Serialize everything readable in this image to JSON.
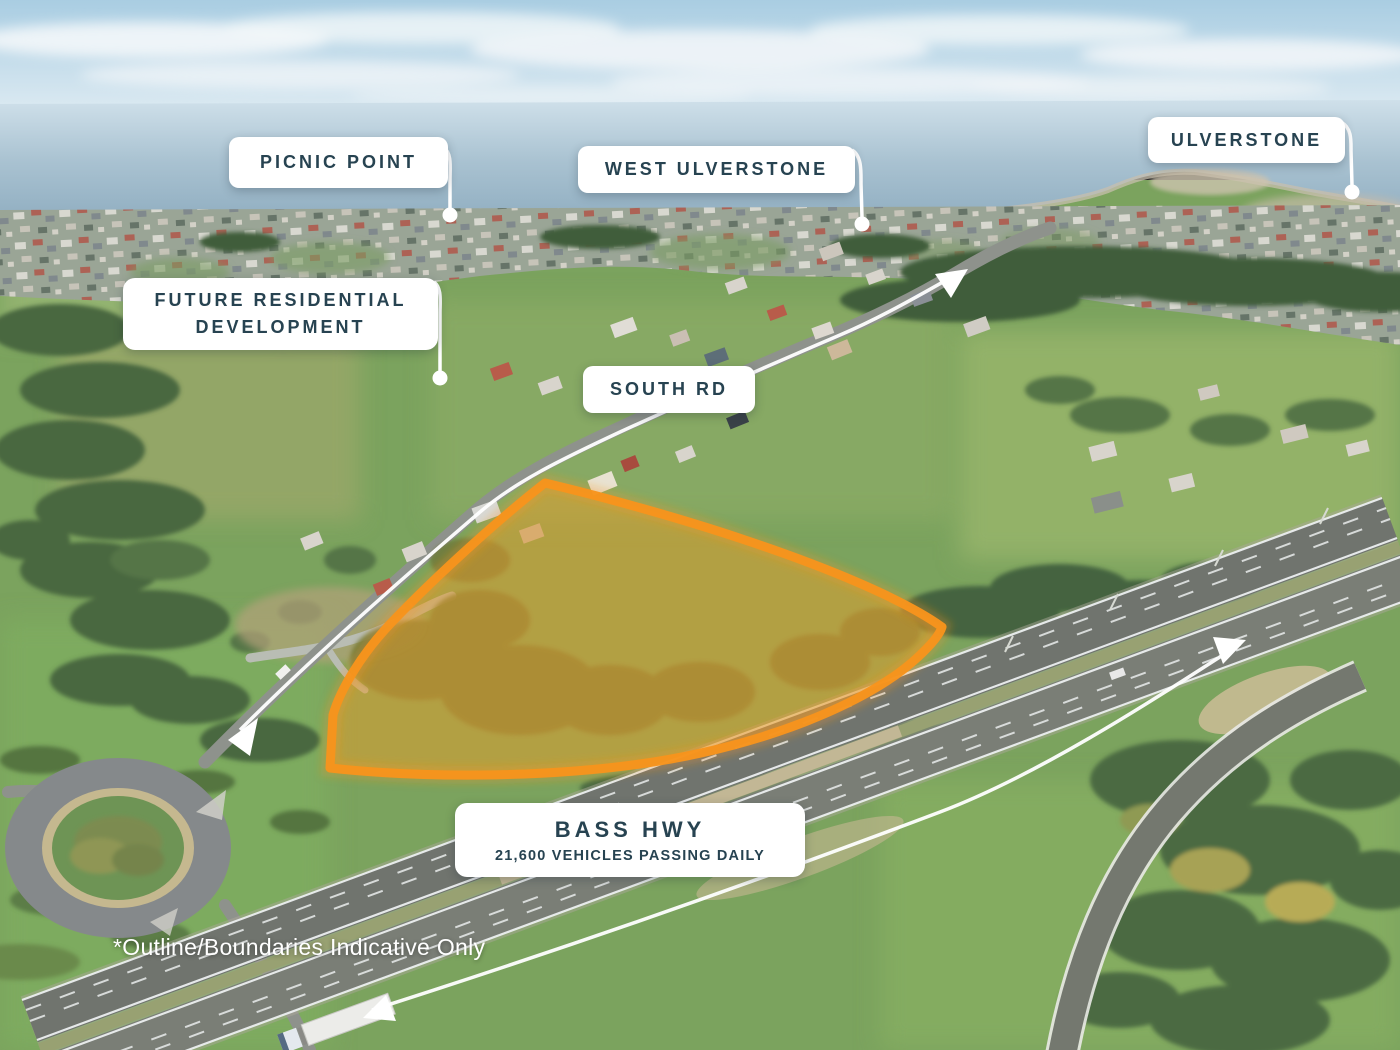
{
  "callouts": {
    "picnic_point": {
      "label": "PICNIC POINT"
    },
    "west_ulverstone": {
      "label": "WEST ULVERSTONE"
    },
    "ulverstone": {
      "label": "ULVERSTONE"
    },
    "future_residential": {
      "line1": "FUTURE RESIDENTIAL",
      "line2": "DEVELOPMENT"
    },
    "south_rd": {
      "label": "SOUTH RD"
    },
    "bass_hwy": {
      "title": "BASS HWY",
      "subtitle": "21,600 VEHICLES PASSING DAILY"
    }
  },
  "footnote": {
    "text": "*Outline/Boundaries Indicative Only"
  },
  "icons": {
    "route_arrow": "white-arrowhead-triangle",
    "leader_dot": "white-circle"
  },
  "colors": {
    "label_text": "#274351",
    "label_background": "#FFFFFF",
    "property_outline": "#F7941D",
    "property_fill": "rgba(243,146,28,0.36)",
    "route_marker": "#FFFFFF"
  }
}
